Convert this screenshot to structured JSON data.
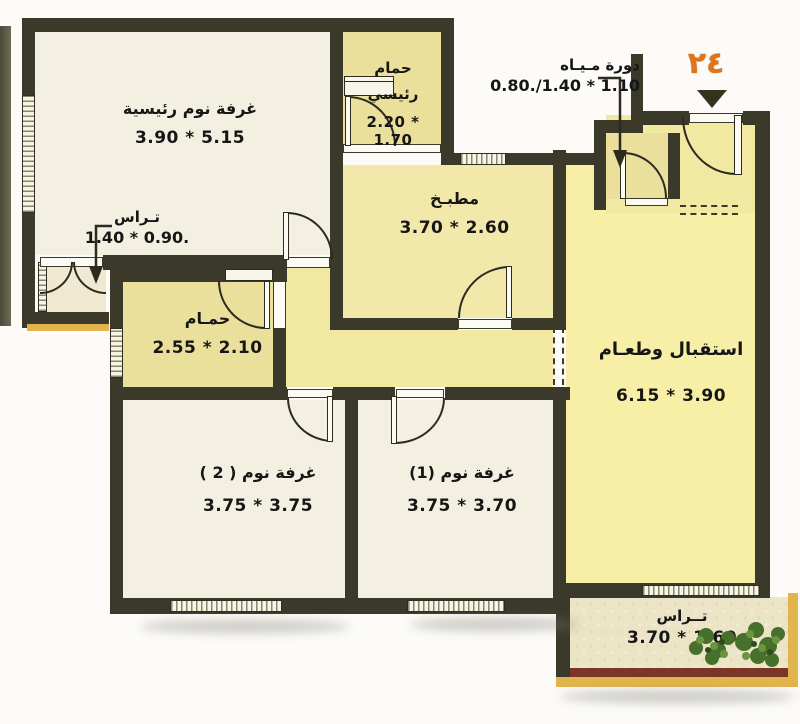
{
  "unit": {
    "number": "٢٤"
  },
  "rooms": {
    "master_bedroom": {
      "name": "غرفة نوم رئيسية",
      "dims": "3.90 * 5.15"
    },
    "master_bath": {
      "name_line1": "حمام",
      "name_line2": "رئيسي",
      "dims": "2.20 * 1.70"
    },
    "kitchen": {
      "name": "مطبـخ",
      "dims": "3.70 * 2.60"
    },
    "wc": {
      "name": "دورة مـيـاه",
      "dims": "0.80./1.40 * 1.10"
    },
    "bathroom": {
      "name": "حمـام",
      "dims": "2.55 * 2.10"
    },
    "bedroom2": {
      "name": "غرفة نوم ( 2 )",
      "dims": "3.75 * 3.75"
    },
    "bedroom1": {
      "name": "غرفة نوم (1)",
      "dims": "3.75 * 3.70"
    },
    "reception": {
      "name": "استقبال وطعـام",
      "dims": "6.15 * 3.90"
    },
    "terrace_side": {
      "name": "تـراس",
      "dims": "1.40 * 0.90."
    },
    "terrace_bottom": {
      "name": "تــراس",
      "dims": "3.70 * 1.60"
    }
  },
  "colors": {
    "wall": "#3b3a2a",
    "room_cream": "#f3f0e2",
    "room_yellow": "#f6efa5",
    "room_khaki": "#eadf9b",
    "kitchen_yellow": "#f1e8aa",
    "hall_yellow": "#f1e9a2",
    "terrace_floor": "#ece4c6",
    "gold_trim": "#e2b44e",
    "terrace_border_brown": "#7a3526",
    "unit_orange": "#e0741a",
    "text": "#161616"
  }
}
